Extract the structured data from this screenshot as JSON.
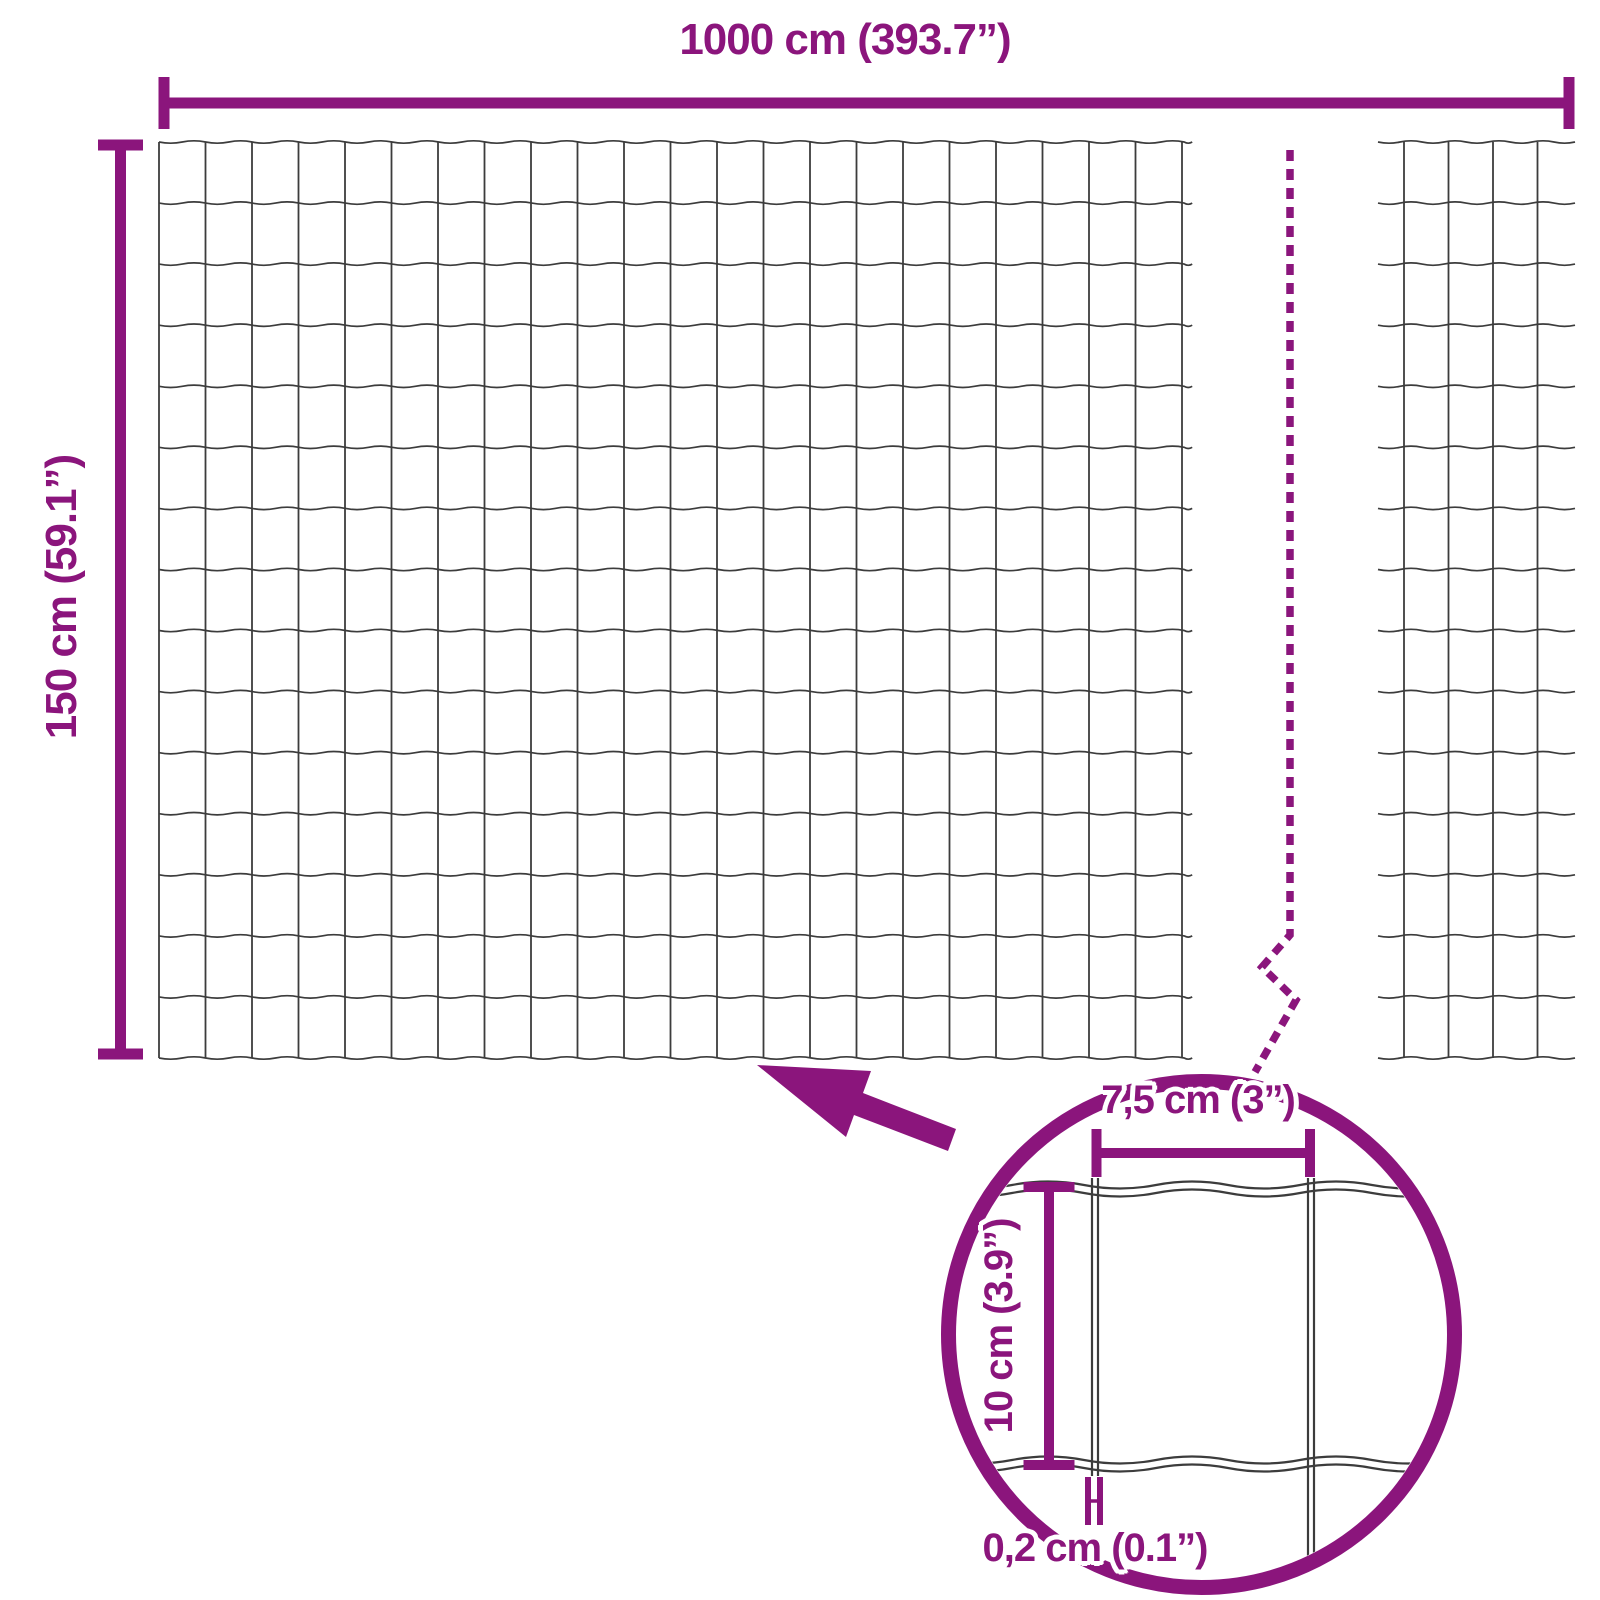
{
  "diagram": {
    "description": "wire-mesh-fence-dimension-diagram",
    "colors": {
      "accent": "#8B157C",
      "wire": "#3C3C3C",
      "background": "#FFFFFF"
    },
    "labels": {
      "total_width": "1000 cm (393.7”)",
      "total_height": "150 cm (59.1”)",
      "cell_width": "7,5 cm (3”)",
      "cell_height": "10 cm (3.9”)",
      "wire_thickness": "0,2 cm (0.1”)"
    },
    "values": {
      "total_width_cm": 1000,
      "total_width_inch": 393.7,
      "total_height_cm": 150,
      "total_height_inch": 59.1,
      "cell_width_cm": 7.5,
      "cell_width_inch": 3,
      "cell_height_cm": 10,
      "cell_height_inch": 3.9,
      "wire_thickness_cm": 0.2,
      "wire_thickness_inch": 0.1
    },
    "geometry": {
      "canvas": {
        "w": 1600,
        "h": 1600
      },
      "top_dim": {
        "y": 103,
        "x1": 164,
        "x2": 1569,
        "cap_half": 26,
        "bar": 11
      },
      "left_dim": {
        "x": 120.5,
        "y1": 145,
        "y2": 1054,
        "cap_half": 22.5,
        "bar": 11
      },
      "main_mesh": {
        "left": 159,
        "top": 142,
        "bottom": 1058,
        "wavy_right": 1190,
        "col_start": 159,
        "col_spacing": 46.5,
        "col_count": 23,
        "row_count": 16,
        "wavelength": 23.25,
        "amp": 2.4
      },
      "right_mesh": {
        "wavy_left": 1378,
        "wavy_right": 1575,
        "top": 142,
        "bottom": 1058,
        "cols": [
          1404,
          1448.5,
          1493,
          1537.5
        ],
        "row_count": 16,
        "wavelength": 22,
        "amp": 2.4
      },
      "break_line": {
        "path": "M 1290 150 L 1290 935 L 1262 967 L 1296 1000 L 1255 1072",
        "width": 7.5,
        "dash": "11 8"
      },
      "arrow_points": "757,1065 871,1071 863,1093 956,1129 948,1151 854,1115 846,1137",
      "circle": {
        "cx": 1201.5,
        "cy": 1334.5,
        "r": 253,
        "stroke": 15,
        "clip_r": 245
      },
      "detail": {
        "wavy_rows": [
          1185,
          1193,
          1460,
          1468
        ],
        "wavy_x1": 940,
        "wavy_x2": 1465,
        "wavelength": 72,
        "amp": 7,
        "left_pair_x": [
          1092,
          1098
        ],
        "left_pair_y": [
          1178,
          1476
        ],
        "right_pair_x": [
          1308,
          1314
        ],
        "right_pair_y": [
          1178,
          1592
        ],
        "wire_stroke": 2.2,
        "dim_w": {
          "y": 1153,
          "x1": 1096.5,
          "x2": 1310,
          "cap_half": 24,
          "bar": 10
        },
        "dim_h": {
          "x": 1049,
          "y1": 1187,
          "y2": 1465,
          "cap_half": 25.5,
          "bar": 10
        },
        "hmark": {
          "x_left": 1088,
          "x_right": 1100,
          "y1": 1477,
          "y2": 1525,
          "bar_w": 6,
          "cross_y": 1501,
          "cross_w": 3.5
        }
      },
      "label_pos": {
        "total_width": {
          "x": 845,
          "y": 40
        },
        "total_height": {
          "x": 62,
          "y": 597
        },
        "cell_width": {
          "x": 1198,
          "y": 1100
        },
        "cell_height": {
          "x": 999,
          "y": 1326
        },
        "wire_thickness": {
          "x": 1095,
          "y": 1548
        }
      }
    }
  }
}
